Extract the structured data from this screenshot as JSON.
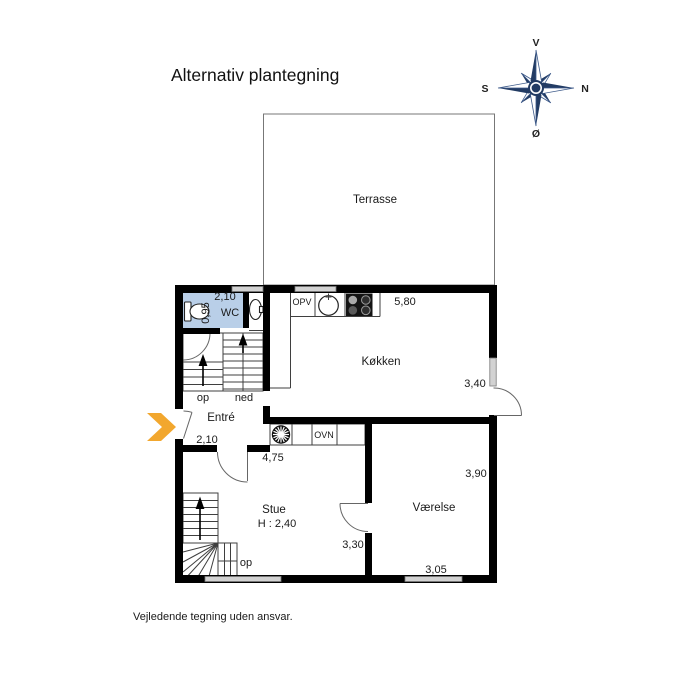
{
  "title": "Alternativ plantegning",
  "disclaimer": "Vejledende tegning uden ansvar.",
  "compass": {
    "west": "V",
    "north": "N",
    "south": "S",
    "east": "Ø"
  },
  "rooms": {
    "terrasse": "Terrasse",
    "wc": "WC",
    "koekken": "Køkken",
    "entre": "Entré",
    "stue": "Stue",
    "stue_ceiling_height": "H : 2,40",
    "vaerelse": "Værelse"
  },
  "dimensions": {
    "wc_width": "2,10",
    "wc_depth": "0,95",
    "koekken_width": "5,80",
    "koekken_depth": "3,40",
    "entre_width": "2,10",
    "stue_width": "4,75",
    "stue_depth": "3,30",
    "vaerelse_depth": "3,90",
    "vaerelse_width": "3,05"
  },
  "fixtures": {
    "dishwasher": "OPV",
    "oven": "OVN"
  },
  "stairs": {
    "up_label": "op",
    "down_label": "ned",
    "lower_up_label": "op"
  },
  "colors": {
    "wall": "#000000",
    "window_gray": "#d2d2d2",
    "wc_fill": "#b9cfe8",
    "compass_navy": "#223b63",
    "arrow_orange": "#f2a72e"
  }
}
